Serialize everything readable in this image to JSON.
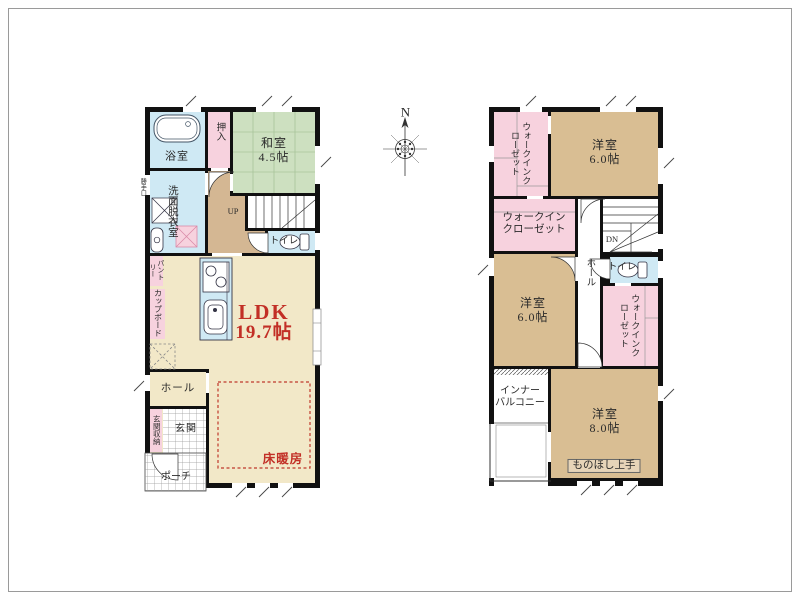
{
  "compass": {
    "north_label": "N"
  },
  "floor1": {
    "bath": "浴室",
    "oshiire": "押入",
    "washitsu_name": "和室",
    "washitsu_size": "4.5帖",
    "senmen": "洗面脱衣室",
    "up": "UP",
    "toilet": "トイレ",
    "back_door": "勝手口",
    "pantry": "パントリー",
    "cupboard": "カップボード",
    "ldk_name": "LDK",
    "ldk_size": "19.7帖",
    "hall": "ホール",
    "genkan_storage": "玄関収納",
    "genkan": "玄関",
    "porch": "ポーチ",
    "floor_heating": "床暖房"
  },
  "floor2": {
    "wic_nw": "ウォークインクローゼット",
    "room1_name": "洋室",
    "room1_size": "6.0帖",
    "wic_mid_line1": "ウォークイン",
    "wic_mid_line2": "クローゼット",
    "dn": "DN",
    "room2_name": "洋室",
    "room2_size": "6.0帖",
    "hall": "ホール",
    "toilet": "トイレ",
    "wic_e": "ウォークインクローゼット",
    "balcony_line1": "インナー",
    "balcony_line2": "バルコニー",
    "room3_name": "洋室",
    "room3_size": "8.0帖",
    "monohoshi": "ものほし上手"
  },
  "colors": {
    "wall": "#111111",
    "western_room": "#d9be93",
    "ldk_floor": "#f2e8c8",
    "japanese_room": "#cde0c0",
    "wet_area_blue": "#cfe9f4",
    "closet_pink": "#f7d2de",
    "stair_hall_brown": "#d4b793",
    "accent_red": "#c22f26"
  }
}
